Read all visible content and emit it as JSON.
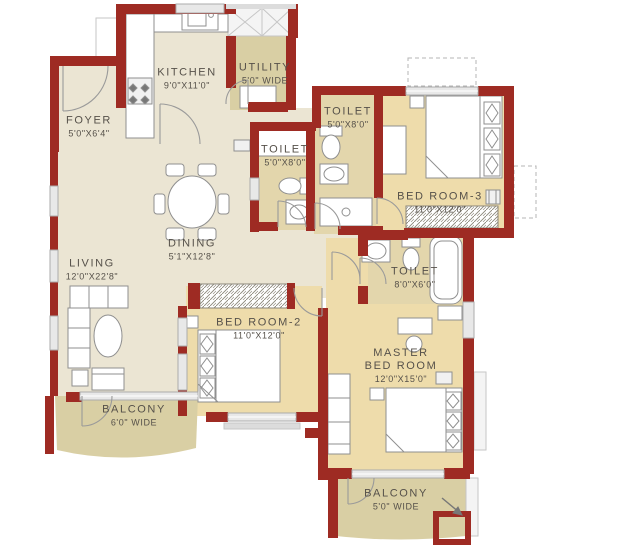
{
  "plan": {
    "type": "apartment-floor-plan",
    "rooms": {
      "kitchen": {
        "name": "KITCHEN",
        "dims": "9'0\"X11'0\""
      },
      "utility": {
        "name": "UTILITY",
        "dims": "5'0\" WIDE"
      },
      "foyer": {
        "name": "FOYER",
        "dims": "5'0\"X6'4\""
      },
      "living": {
        "name": "LIVING",
        "dims": "12'0\"X22'8\""
      },
      "dining": {
        "name": "DINING",
        "dims": "5'1\"X12'8\""
      },
      "toilet_left": {
        "name": "TOILET",
        "dims": "5'0\"X8'0\""
      },
      "toilet_top": {
        "name": "TOILET",
        "dims": "5'0\"X8'0\""
      },
      "toilet_master": {
        "name": "TOILET",
        "dims": "8'0\"X6'0\""
      },
      "bedroom3": {
        "name": "BED ROOM-3",
        "dims": "11'0\"X12'0\""
      },
      "bedroom2": {
        "name": "BED ROOM-2",
        "dims": "11'0\"X12'0\""
      },
      "master_bedroom": {
        "line1": "MASTER",
        "line2": "BED ROOM",
        "dims": "12'0\"X15'0\""
      },
      "balcony_living": {
        "name": "BALCONY",
        "dims": "6'0\" WIDE"
      },
      "balcony_master": {
        "name": "BALCONY",
        "dims": "5'0\" WIDE"
      }
    },
    "colors": {
      "wall": "#9e2b23",
      "floor_living": "#ebe5d3",
      "floor_bedroom": "#eedcab",
      "floor_toilet": "#e3d6ac",
      "floor_balcony": "#d9cfa4",
      "window": "#e8e8e8",
      "fixture_stroke": "#8f8f8f",
      "text": "#56514a"
    }
  }
}
